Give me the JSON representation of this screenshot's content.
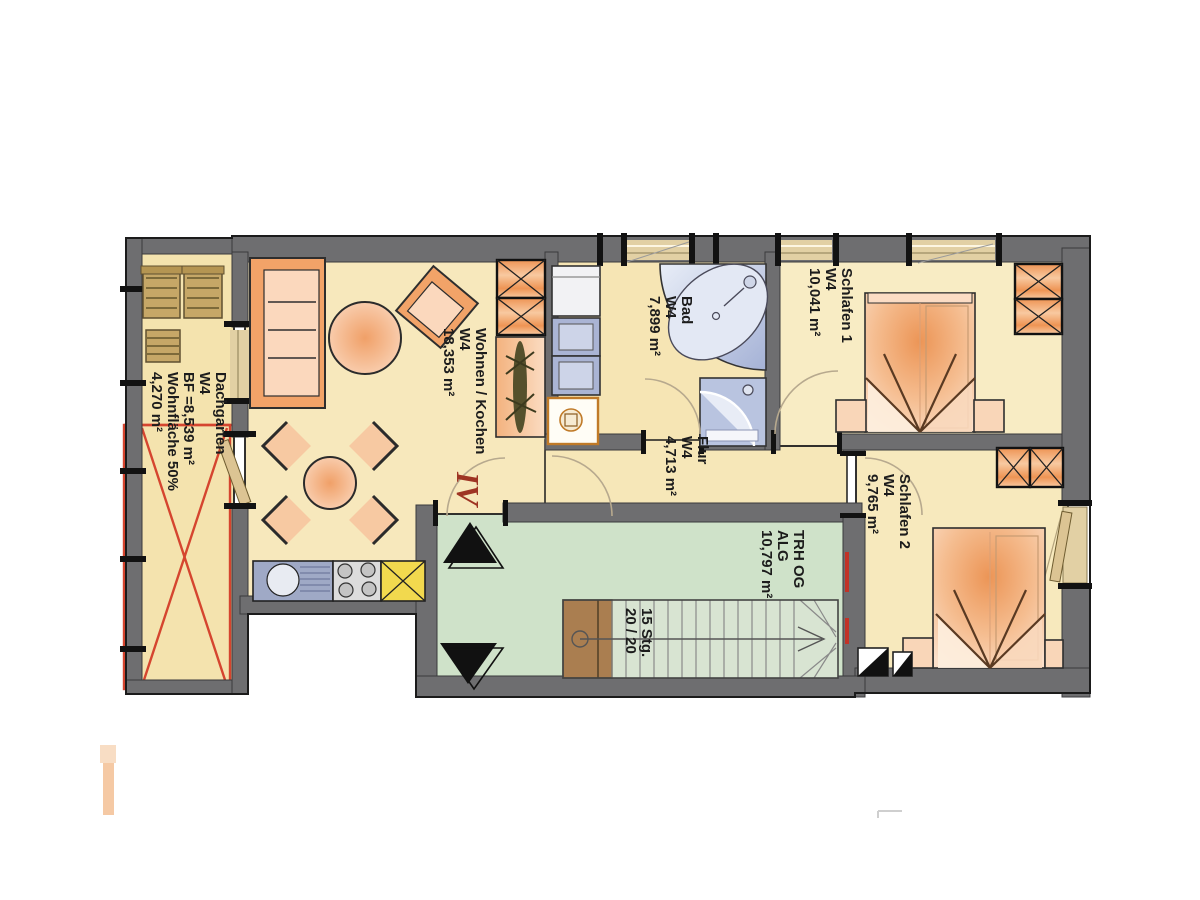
{
  "plan": {
    "unit_label": "IV",
    "rooms": {
      "dachgarten": {
        "lines": [
          "Dachgarten",
          "W4",
          "BF =8,539 m²",
          "Wohnfläche 50%",
          "4,270 m²"
        ]
      },
      "wohnen_kochen": {
        "lines": [
          "Wohnen / Kochen",
          "W4",
          "18,353 m²"
        ]
      },
      "bad": {
        "lines": [
          "Bad",
          "W4",
          "7,899 m²"
        ]
      },
      "flur": {
        "lines": [
          "Flur",
          "W4",
          "4,713 m²"
        ]
      },
      "schlafen1": {
        "lines": [
          "Schlafen 1",
          "W4",
          "10,041 m²"
        ]
      },
      "schlafen2": {
        "lines": [
          "Schlafen 2",
          "W4",
          "9,765 m²"
        ]
      },
      "treppenhaus": {
        "lines": [
          "TRH OG",
          "ALG",
          "10,797 m²"
        ]
      }
    },
    "stairs": {
      "lines": [
        "15 Stg.",
        "20 / 20"
      ]
    },
    "colors": {
      "wall": "#6e6e70",
      "floor": "#f6e7ba",
      "stairwell_floor": "#cfe2c9",
      "furniture_orange": "#f2a368",
      "kitchen_blue": "#9fa9c6",
      "cabinet_yellow": "#f2d94e",
      "bath_blue": "#b9c4e0",
      "stair_wood": "#aa7e50",
      "marking_red": "#d5452f",
      "unit_label_red": "#9e3423"
    }
  }
}
